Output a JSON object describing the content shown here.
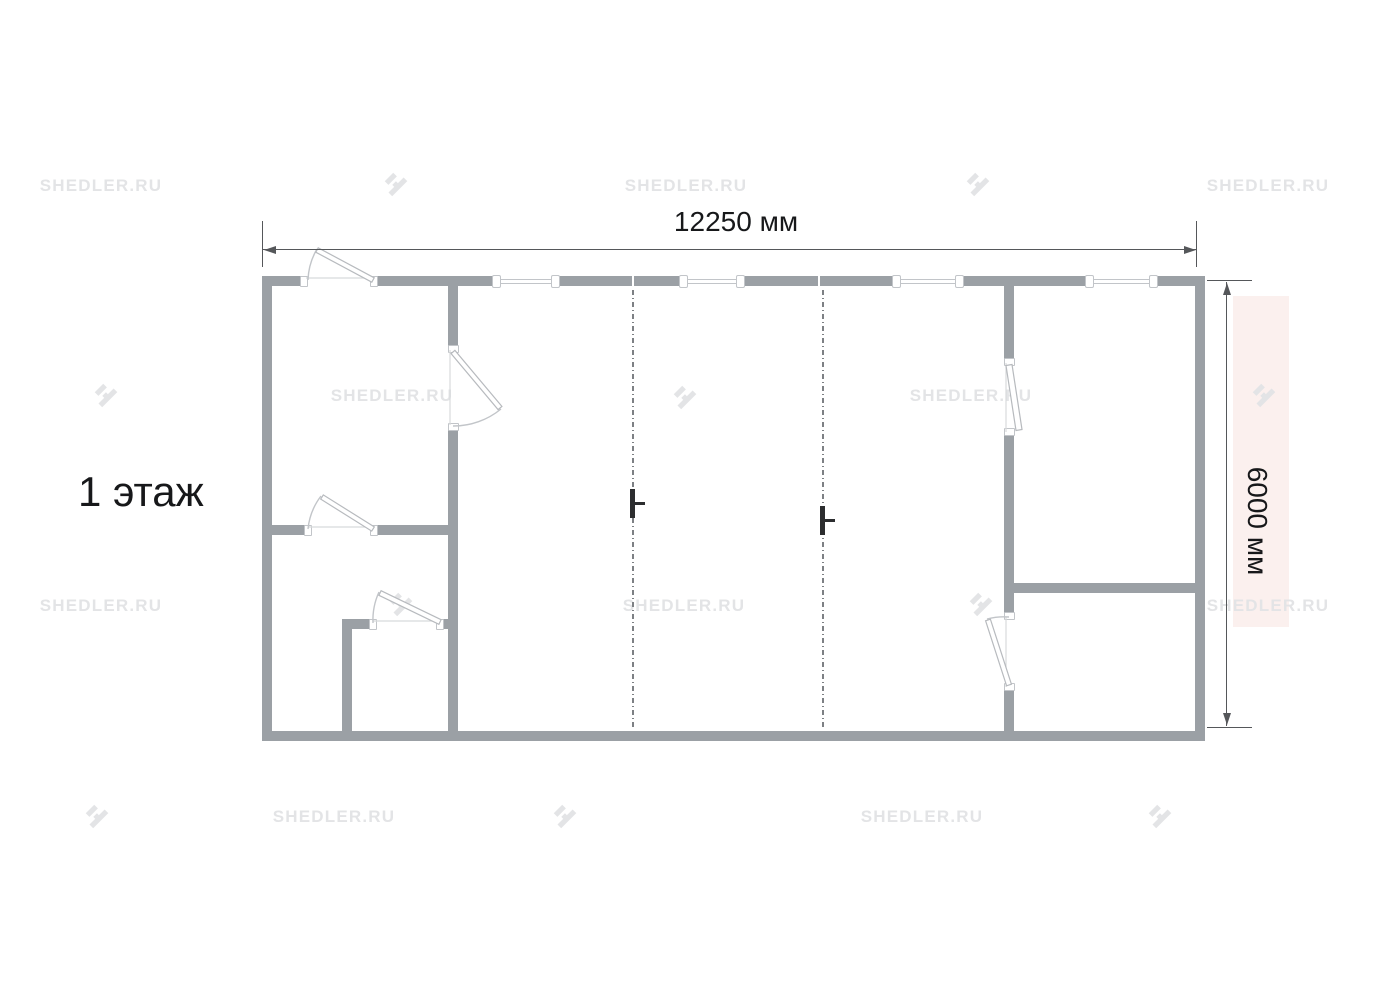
{
  "floor_label": "1 этаж",
  "dimensions": {
    "width_label": "12250 мм",
    "height_label": "6000 мм"
  },
  "watermark": {
    "text": "SHEDLER.RU"
  },
  "colors": {
    "wall": "#9ba0a5",
    "thin": "#c2c5c9",
    "dimension": "#55575a",
    "label": "#17181a",
    "watermark": "#e3e4e6",
    "pink": "#fbf0ee",
    "dashed": "#7d8084",
    "marker": "#2c2d2f"
  }
}
